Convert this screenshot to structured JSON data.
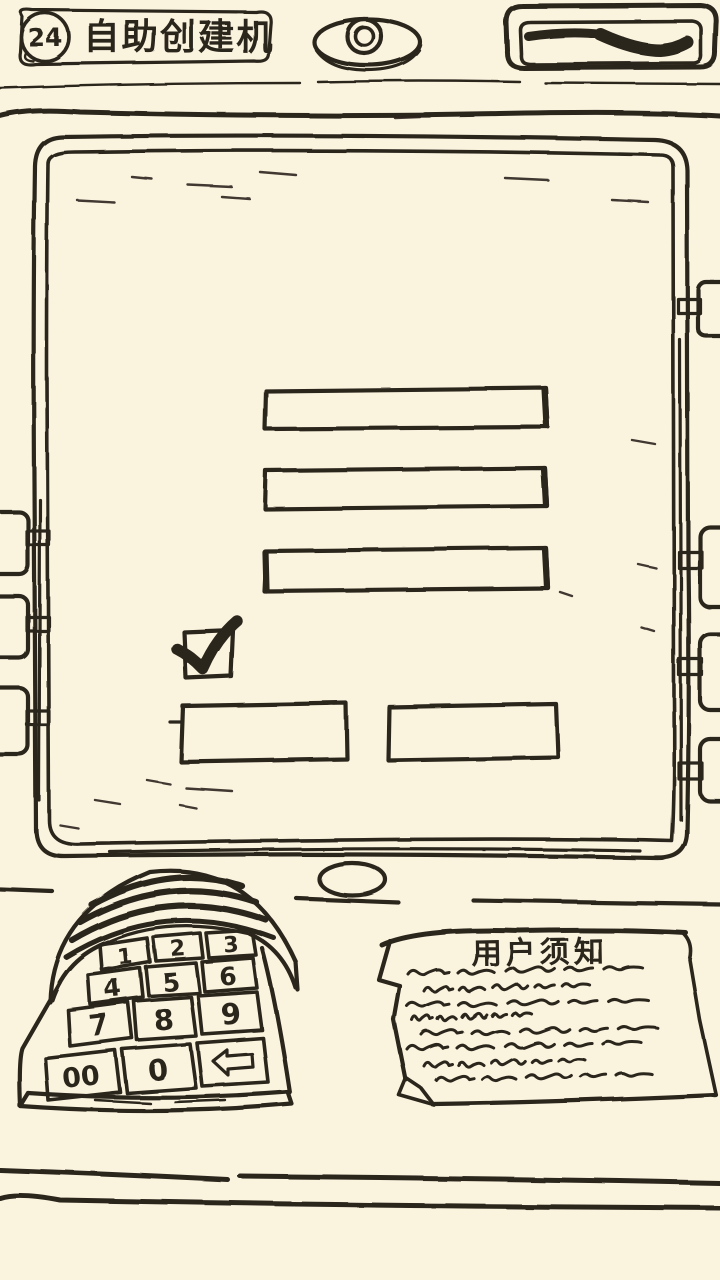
{
  "colors": {
    "paper": "#faf3de",
    "ink": "#2b251e"
  },
  "header": {
    "level_badge": "24",
    "title": "自助创建机"
  },
  "machine": {
    "camera": "camera-lens",
    "card_slot": "card-slot"
  },
  "screen": {
    "input_values": [
      "",
      "",
      ""
    ],
    "checkbox_checked": true,
    "button_labels": [
      "",
      ""
    ]
  },
  "keypad": {
    "keys": [
      "1",
      "2",
      "3",
      "4",
      "5",
      "6",
      "7",
      "8",
      "9",
      "00",
      "0"
    ],
    "backspace_icon": "left-arrow"
  },
  "notice": {
    "title": "用户须知"
  }
}
